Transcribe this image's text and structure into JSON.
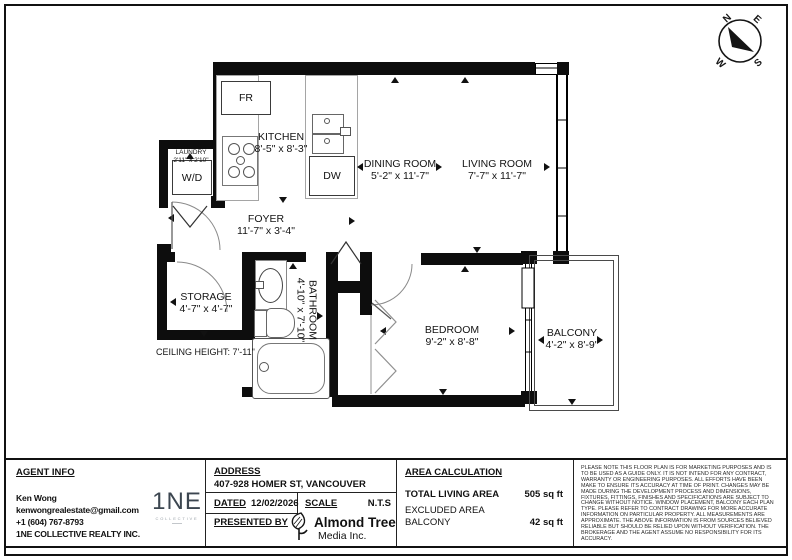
{
  "compass": {
    "n": "N",
    "e": "E",
    "s": "S",
    "w": "W"
  },
  "plan": {
    "rooms": [
      {
        "name": "KITCHEN",
        "dims": "8'-5\" x 8'-3\""
      },
      {
        "name": "DINING ROOM",
        "dims": "5'-2\" x 11'-7\""
      },
      {
        "name": "LIVING ROOM",
        "dims": "7'-7\" x 11'-7\""
      },
      {
        "name": "FOYER",
        "dims": "11'-7\" x 3'-4\""
      },
      {
        "name": "LAUNDRY",
        "dims": "2'11\" x 2'10\""
      },
      {
        "name": "STORAGE",
        "dims": "4'-7\" x 4'-7\""
      },
      {
        "name": "BATHROOM",
        "dims": "4'-10\" x 7'-10\""
      },
      {
        "name": "BEDROOM",
        "dims": "9'-2\" x 8'-8\""
      },
      {
        "name": "BALCONY",
        "dims": "4'-2\" x 8'-9\""
      }
    ],
    "fixtures": {
      "fridge": "FR",
      "washer_dryer": "W/D",
      "dishwasher": "DW"
    },
    "ceiling_note": "CEILING HEIGHT: 7'-11\""
  },
  "info_bar": {
    "agent": {
      "heading": "AGENT INFO",
      "name": "Ken Wong",
      "email": "kenwongrealestate@gmail.com",
      "phone": "+1 (604) 767-8793",
      "company": "1NE COLLECTIVE REALTY INC.",
      "logo_main": "1NE",
      "logo_sub": "COLLECTIVE"
    },
    "address": {
      "heading": "ADDRESS",
      "value": "407-928 HOMER ST, VANCOUVER"
    },
    "dated": {
      "heading": "DATED",
      "value": "12/02/2026"
    },
    "scale": {
      "heading": "SCALE",
      "value": "N.T.S"
    },
    "presented_by": {
      "heading": "PRESENTED BY",
      "company_line1": "Almond Tree",
      "company_line2": "Media Inc."
    },
    "area": {
      "heading": "AREA CALCULATION",
      "total_label": "TOTAL LIVING AREA",
      "total_value": "505 sq ft",
      "excluded_label": "EXCLUDED AREA",
      "balcony_label": "BALCONY",
      "balcony_value": "42 sq ft"
    },
    "disclaimer": "PLEASE NOTE THIS FLOOR PLAN IS FOR MARKETING PURPOSES AND IS TO BE USED AS A GUIDE ONLY. IT IS NOT INTEND FOR ANY CONTRACT, WARRANTY OR ENGINEERING PURPOSES. ALL EFFORTS HAVE BEEN MAKE TO ENSURE ITS ACCURACY AT TIME OF PRINT. CHANGES MAY BE MADE DURING THE DEVELOPMENT PROCESS AND DIMENSIONS, FIXTURES, FITTINGS, FINISHES AND SPECIFICATIONS ARE SUBJECT TO CHANGE WITHOUT NOTICE. WINDOW PLACEMENT, BALCONY EACH PLAN TYPE. PLEASE REFER TO CONTRACT DRAWING FOR MORE ACCURATE INFORMATION ON PARTICULAR PROPERTY. ALL MEASUREMENTS ARE APPROXIMATE. THE ABOVE INFORMATION IS FROM SOURCES BELIEVED RELIABLE BUT SHOULD BE RELIED UPON WITHOUT VERIFICATION. THE BROKERAGE AND THE AGENT ASSUME NO RESPONSIBILITY FOR ITS ACCURACY."
  },
  "colors": {
    "wall": "#0d0d0d",
    "logo_navy": "#3c4650"
  }
}
